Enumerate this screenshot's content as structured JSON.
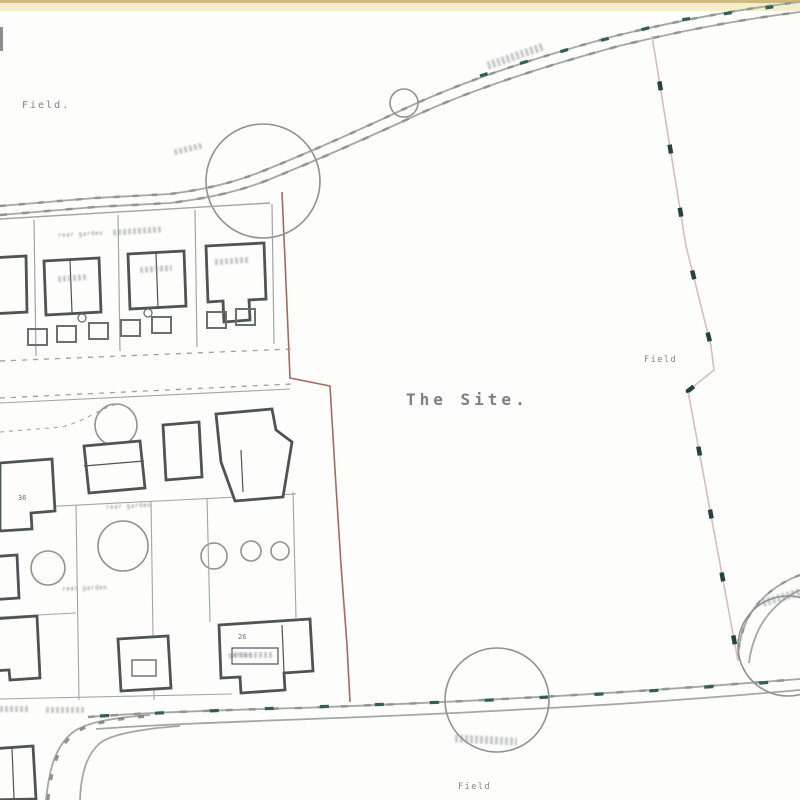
{
  "drawing": {
    "kind": "scanned site plan",
    "labels": {
      "field_top_left": "Field.",
      "the_site": "The Site.",
      "field_right": "Field",
      "field_bottom": "Field",
      "plot_36": "36",
      "plot_26": "26",
      "rear_garden_upper": "rear garden",
      "rear_garden_mid": "rear garden",
      "rear_garden_lower": "rear garden",
      "garden_bottom": "garden"
    },
    "colors": {
      "paper": "#fdfdfb",
      "scan_band": "#f6eecb",
      "scan_band_edge": "#cdb97a",
      "line_gray": "#a3a7a5",
      "house_outline": "#4e5354",
      "boundary_red": "#9c584c",
      "boundary_pink": "#d9bcbc",
      "hedge_teal": "#2f6053",
      "text_gray": "#7e8489"
    }
  }
}
